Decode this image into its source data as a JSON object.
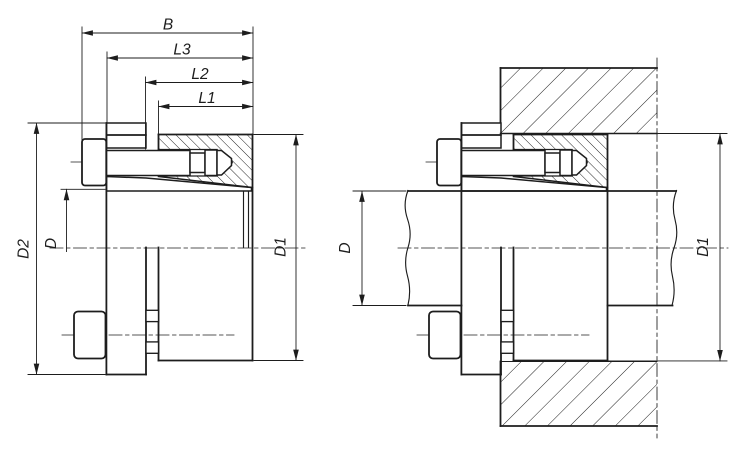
{
  "drawing": {
    "background": "#ffffff",
    "line_color": "#1d1d1d",
    "views": {
      "left": {
        "name": "sectional-view-clamping-element",
        "dimensions": {
          "B": "B",
          "L3": "L3",
          "L2": "L2",
          "L1": "L1",
          "D2": "D2",
          "D": "D",
          "D1": "D1"
        }
      },
      "right": {
        "name": "installed-view-shaft-and-hub",
        "dimensions": {
          "D": "D",
          "D1": "D1"
        }
      }
    }
  }
}
